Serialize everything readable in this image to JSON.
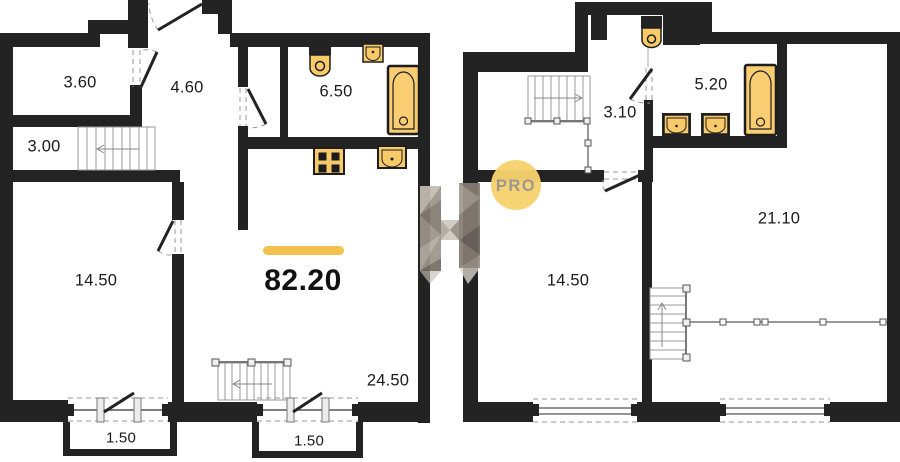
{
  "title": "apartment-floor-plan",
  "colors": {
    "wall": "#232323",
    "accent_yellow": "#f3c14d",
    "fixture_fill": "#f8ca69",
    "bathtub_fill": "#f9cd72",
    "fixture_stroke": "#1d1d1d",
    "pro_circle": "#f6d16d",
    "pro_text": "#9e978d",
    "label_text": "#1a1a1a",
    "thin_line": "#999999"
  },
  "floor1": {
    "total_area": "82.20",
    "rooms": [
      {
        "name": "entry-hall",
        "area": "3.60"
      },
      {
        "name": "corridor",
        "area": "4.60"
      },
      {
        "name": "bathroom",
        "area": "6.50"
      },
      {
        "name": "stair-hall",
        "area": "3.00"
      },
      {
        "name": "room",
        "area": "14.50"
      },
      {
        "name": "living-kitchen",
        "area": "24.50"
      },
      {
        "name": "balcony-left",
        "area": "1.50"
      },
      {
        "name": "balcony-right",
        "area": "1.50"
      }
    ]
  },
  "floor2": {
    "rooms": [
      {
        "name": "hall",
        "area": "3.10"
      },
      {
        "name": "bathroom",
        "area": "5.20"
      },
      {
        "name": "living-room",
        "area": "21.10"
      },
      {
        "name": "room",
        "area": "14.50"
      }
    ]
  },
  "watermark": {
    "logo_letter": "H",
    "pro_label": "PRO"
  }
}
